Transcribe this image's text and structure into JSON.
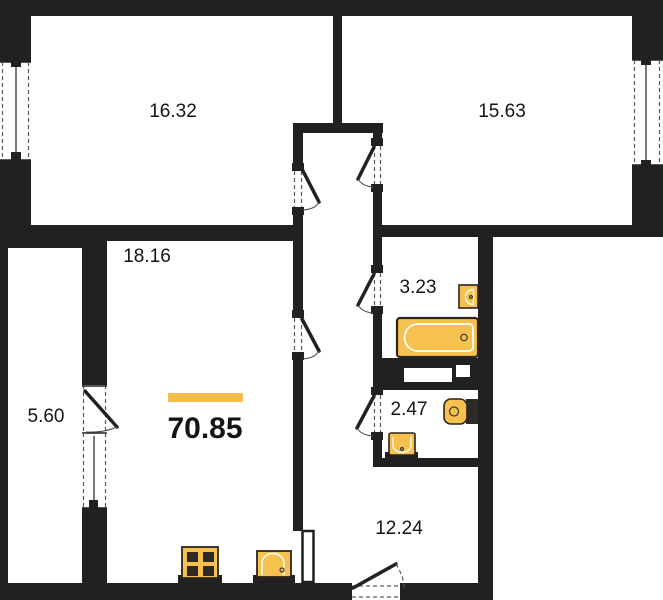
{
  "colors": {
    "wall": "#212121",
    "fixture": "#F7C14F",
    "accent": "#F3BC4D",
    "background": "#FFFFFF",
    "text": "#141414"
  },
  "total_area": "70.85",
  "rooms": [
    {
      "id": "room-top-left",
      "area": "16.32"
    },
    {
      "id": "room-top-right",
      "area": "15.63"
    },
    {
      "id": "living-room",
      "area": "18.16"
    },
    {
      "id": "balcony",
      "area": "5.60"
    },
    {
      "id": "bathroom",
      "area": "3.23"
    },
    {
      "id": "wc",
      "area": "2.47"
    },
    {
      "id": "hallway",
      "area": "12.24"
    }
  ],
  "fixtures": [
    "bathtub",
    "bathroom-sink",
    "toilet",
    "wc-sink",
    "stove",
    "kitchen-sink"
  ]
}
